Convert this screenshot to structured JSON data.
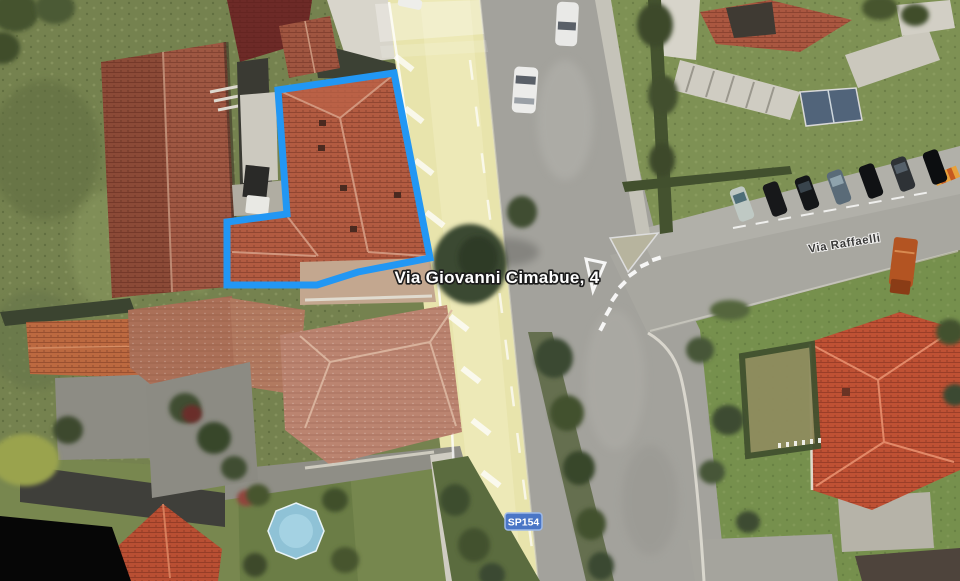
{
  "map": {
    "view": "satellite-aerial",
    "labels": {
      "address": "Via Giovanni Cimabue, 4",
      "street": "Via Raffaelli",
      "route_badge": "SP154"
    },
    "colors": {
      "property_outline": "#2297f4",
      "badge_bg": "#4a76c6",
      "badge_border": "#9db9e8",
      "badge_text": "#ffffff",
      "address_text": "#ffffff",
      "address_halo": "#1c1c1c",
      "street_text": "#262626",
      "route_highlight": "#e8e4ac"
    },
    "property_boundary": {
      "points": "278,90 394,73 430,258 358,272 317,285 227,285 227,222 287,214",
      "stroke_width": 7
    }
  }
}
